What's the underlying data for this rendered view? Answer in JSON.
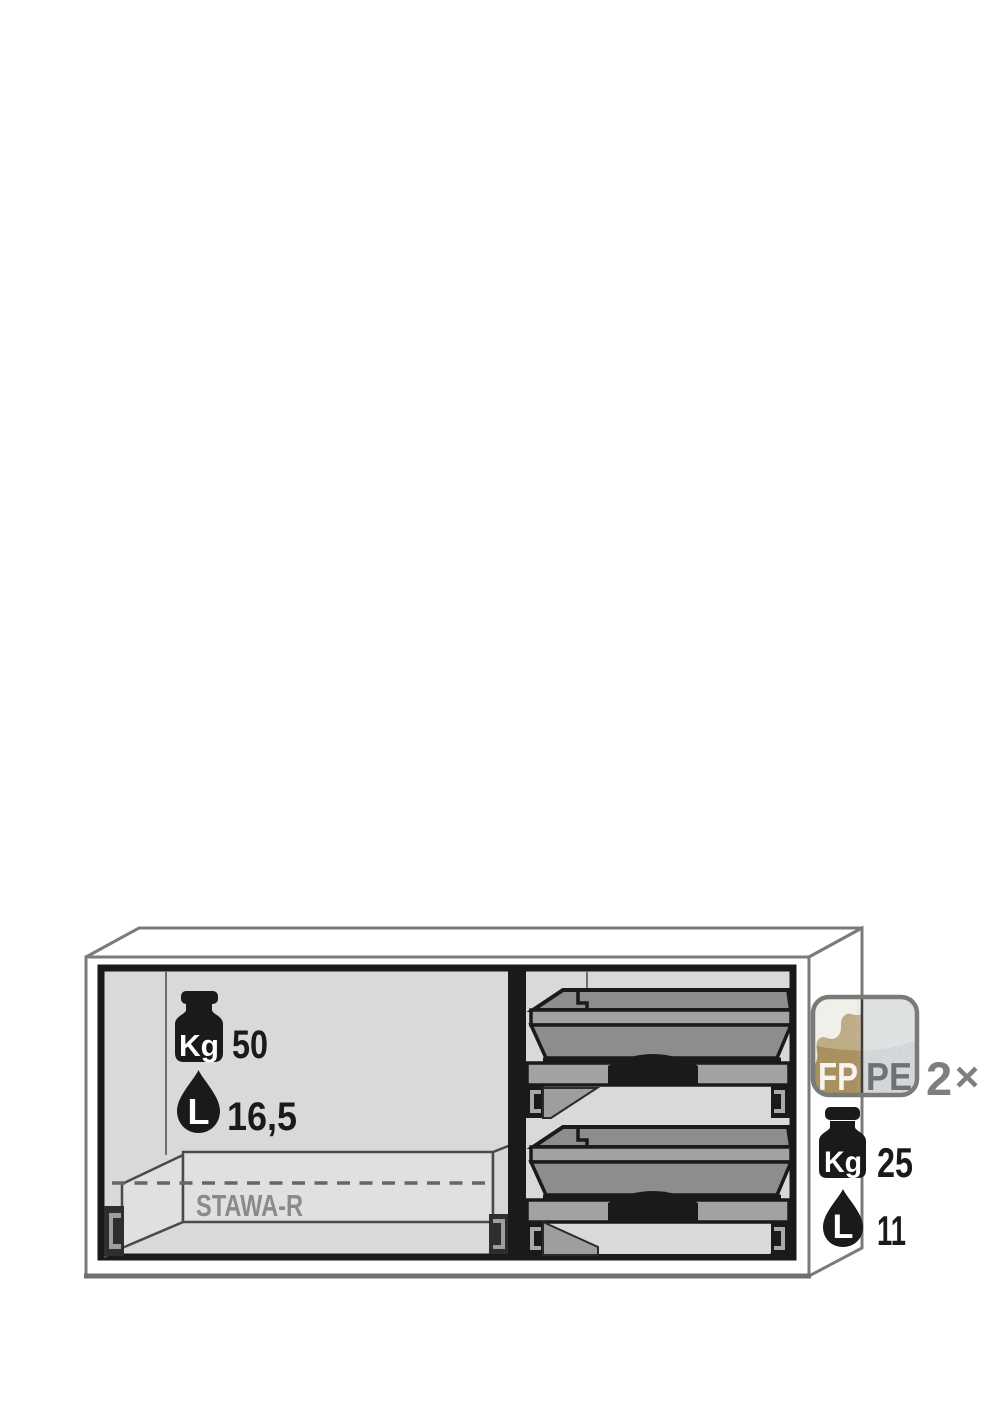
{
  "diagram": {
    "left_compartment": {
      "load_icon_label": "Kg",
      "load_value": "50",
      "volume_icon_label": "L",
      "volume_value": "16,5",
      "tray_label": "STAWA-R"
    },
    "right_compartment": {
      "drawer_count": 2
    },
    "side_annotations": {
      "badge_left_label": "FP",
      "badge_right_label": "PE",
      "badge_quantity": "2",
      "badge_quantity_suffix": "×",
      "drawer_load_icon_label": "Kg",
      "drawer_load_value": "25",
      "drawer_volume_icon_label": "L",
      "drawer_volume_value": "11"
    },
    "colors": {
      "interior_gray": "#d9d9d9",
      "drawer_gray": "#8d8d8d",
      "rim_gray": "#a2a2a2",
      "outline_gray": "#7b7b7b",
      "ink_black": "#1a1a1a",
      "label_gray": "#8a8a8a",
      "badge_gold": "#a8905f",
      "badge_plastic_gray": "#d9dcde",
      "annotation_gray": "#7f7f7f"
    }
  }
}
